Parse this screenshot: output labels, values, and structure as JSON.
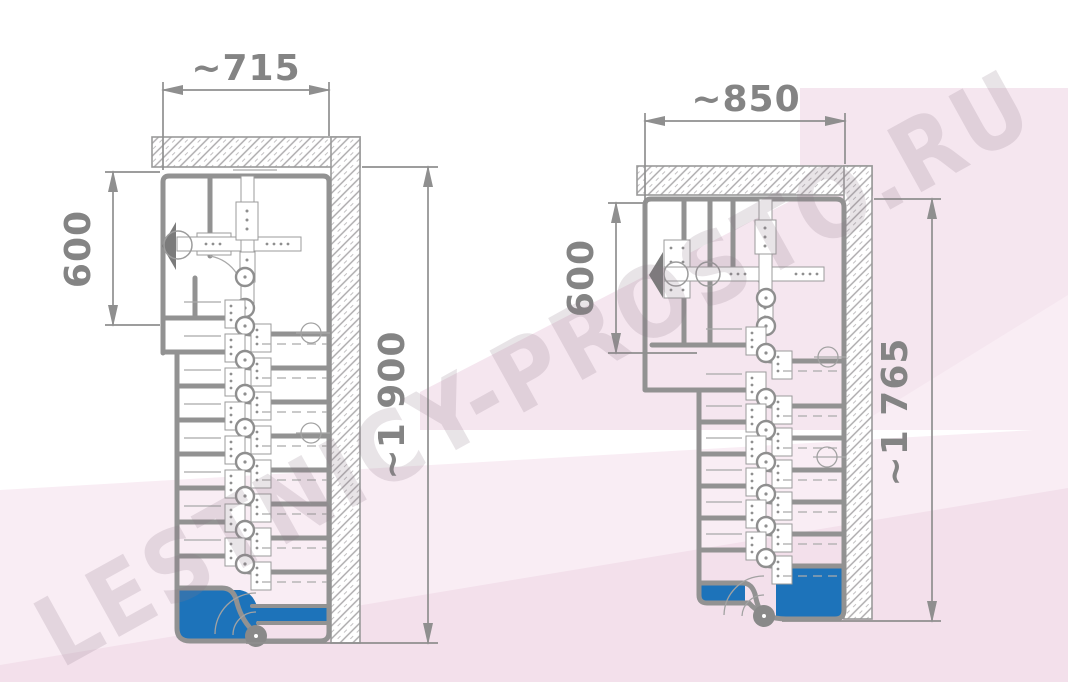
{
  "watermark": {
    "text": "LESTNICY-PROSTO.RU"
  },
  "colors": {
    "line_gray": "#8f8f8f",
    "accent_blue": "#1d73ba",
    "wall_hatch_gray": "#a9a7a9",
    "background_pink": "#f5e6ef",
    "background_pink_light": "#f9edf4",
    "background_pink_deep": "#f3e0eb"
  },
  "drawings": {
    "left": {
      "width_label": "~715",
      "entry_depth_label": "600",
      "length_label": "~1 900"
    },
    "right": {
      "width_label": "~850",
      "entry_depth_label": "600",
      "length_label": "~1 765"
    }
  }
}
